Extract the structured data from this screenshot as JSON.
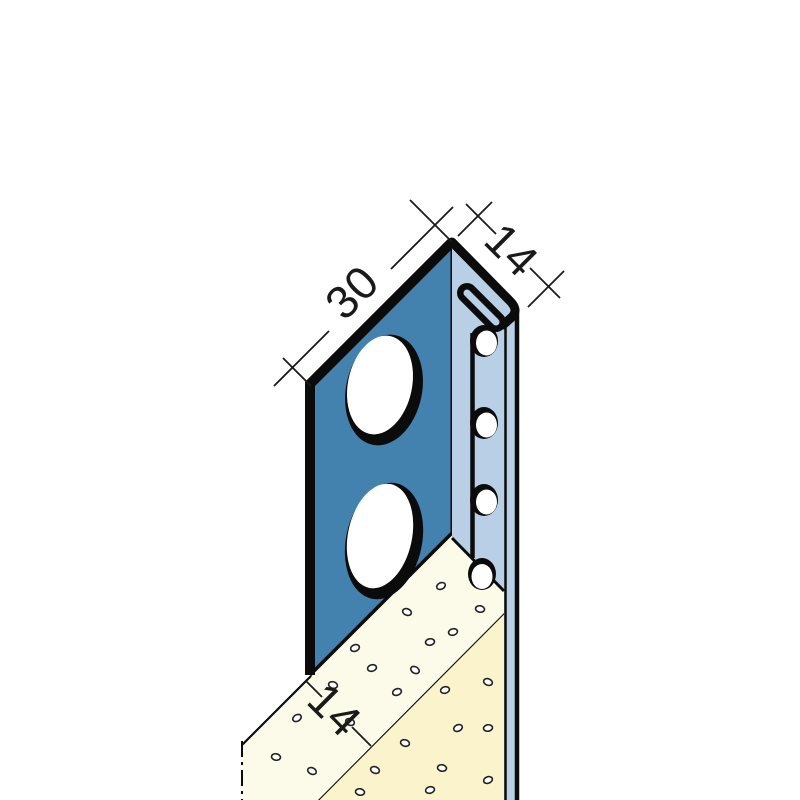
{
  "title": "Isometric technical drawing of an edge/stop bead profile embedded in plaster",
  "dimensions": {
    "flange_width": {
      "label": "30"
    },
    "return_depth": {
      "label": "14"
    },
    "plaster_thickness": {
      "label": "14"
    }
  },
  "colors": {
    "profile_front": "#4381AF",
    "profile_side": "#B9CFE5",
    "plaster_top": "#FCFAE9",
    "plaster_front": "#FAF3CB",
    "outline": "#0B0B0B",
    "dimension_lines": "#1A1A1A",
    "background": "#FFFFFF"
  }
}
